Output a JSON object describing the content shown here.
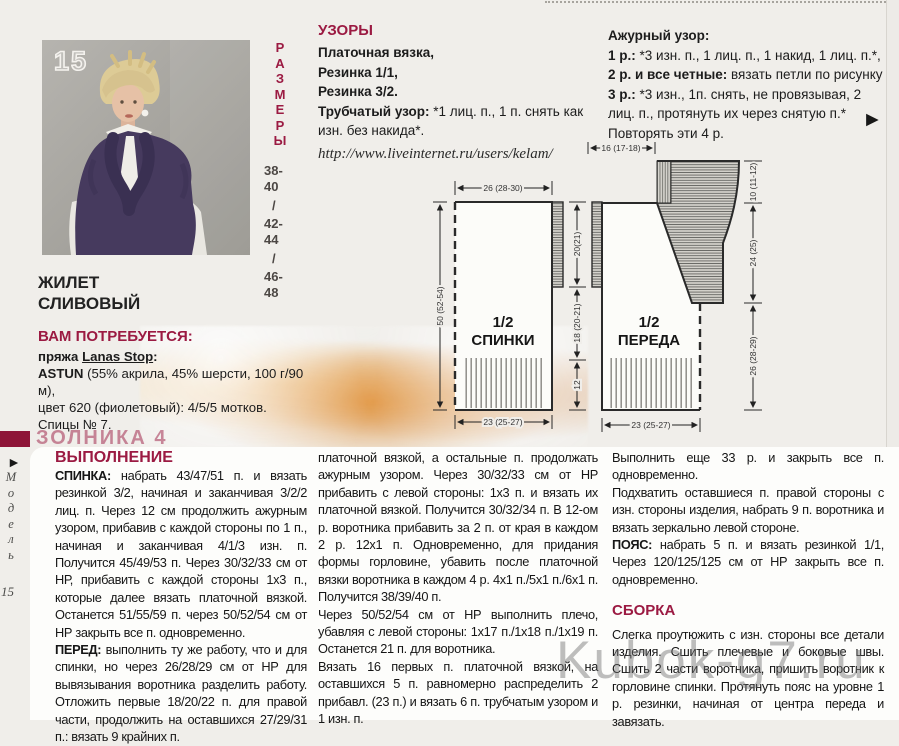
{
  "page": {
    "watermark": "Kubok-g7.ru"
  },
  "icons": {
    "pointer": "►"
  },
  "photo": {
    "number": "15"
  },
  "sizes": {
    "letters": [
      "Р",
      "А",
      "З",
      "М",
      "Е",
      "Р",
      "Ы"
    ],
    "values": [
      "38-",
      "40",
      "/",
      "42-",
      "44",
      "/",
      "46-",
      "48"
    ]
  },
  "left": {
    "title_line1": "ЖИЛЕТ",
    "title_line2": "СЛИВОВЫЙ",
    "requires_heading": "ВАМ ПОТРЕБУЕТСЯ:",
    "yarn_prefix": "пряжа ",
    "yarn_brand": "Lanas Stop",
    "yarn_brand_suffix": ":",
    "yarn_name": "ASTUN",
    "yarn_details": " (55% акрила, 45% шерсти, 100 г/90 м),",
    "yarn_color_line": "цвет 620 (фиолетовый): 4/5/5 мотков.",
    "needles": "Спицы № 7."
  },
  "patterns": {
    "heading": "УЗОРЫ",
    "line1": "Платочная вязка,",
    "line2": "Резинка 1/1,",
    "line3": "Резинка 3/2.",
    "tubular_label": "Трубчатый узор:",
    "tubular_text": " *1 лиц. п., 1 п. снять как изн. без накида*.",
    "url": "http://www.liveinternet.ru/users/kelam/"
  },
  "openwork": {
    "heading": "Ажурный узор:",
    "row1_label": "1 р.:",
    "row1_text": " *3 изн. п., 1 лиц. п., 1 накид, 1 лиц. п.*,",
    "row2_label": "2 р. и все четные:",
    "row2_text": " вязать петли по рисунку",
    "row3_label": "3 р.:",
    "row3_text": " *3 изн., 1п. снять, не провязывая, 2 лиц. п., протянуть их через снятую п.*",
    "repeat_line": "Повторять эти 4 р."
  },
  "diagram": {
    "back": {
      "half": "1/2",
      "name": "СПИНКИ",
      "width_top": "26 (28-30)",
      "width_bottom": "23 (25-27)",
      "height_left": "50 (52-54)",
      "seg_top": "20(21)",
      "seg_mid": "18 (20-21)",
      "seg_bottom": "12"
    },
    "front": {
      "half": "1/2",
      "name": "ПЕРЕДА",
      "width_top": "16 (17-18)",
      "width_bottom": "23 (25-27)",
      "seg_top": "10 (11-12)",
      "seg_mid": "24 (25)",
      "seg_bottom": "26 (28-29)"
    }
  },
  "instructions": {
    "heading": "ВЫПОЛНЕНИЕ",
    "col1": {
      "p1_label": "СПИНКА:",
      "p1_text": " набрать 43/47/51 п. и вязать резинкой 3/2, начиная и заканчивая 3/2/2 лиц. п. Через 12 см продолжить ажурным узором, прибавив с каждой стороны по 1 п., начиная и заканчивая 4/1/3 изн. п. Получится 45/49/53 п. Через 30/32/33 см от НР, прибавить с каждой стороны 1х3 п., которые далее вязать платочной вязкой. Останется 51/55/59 п. через 50/52/54 см от НР закрыть все п. одновременно.",
      "p2_label": "ПЕРЕД:",
      "p2_text": " выполнить ту же работу, что и для спинки, но через 26/28/29 см от НР для  вывязывания воротника разделить работу. Отложить первые  18/20/22 п. для правой части, продолжить на оставшихся 27/29/31 п.: вязать 9 крайних п."
    },
    "col2": {
      "p1": "платочной вязкой, а остальные п. продолжать ажурным узором. Через 30/32/33 см от НР прибавить с левой стороны: 1х3 п. и вязать их платочной вязкой. Получится 30/32/34 п. В 12-ом р. воротника прибавить за 2 п. от края в каждом 2 р. 12х1 п. Одновременно, для придания формы горловине, убавить после платочной вязки воротника в каждом 4 р. 4х1 п./5х1 п./6х1 п. Получится 38/39/40 п.",
      "p2": "Через 50/52/54 см от НР выполнить плечо, убавляя с левой стороны: 1х17 п./1х18 п./1х19 п. Останется 21 п. для воротника.",
      "p3": "Вязать 16 первых п. платочной вязкой, на оставшихся 5 п. равномерно распределить 2 прибавл. (23 п.) и вязать 6 п. трубчатым узором и 1 изн. п."
    },
    "col3": {
      "p1": "Выполнить еще 33 р. и закрыть все п. одновременно.",
      "p2": "Подхватить оставшиеся п.  правой стороны с изн. стороны изделия, набрать 9 п. воротника и вязать зеркально левой стороне.",
      "belt_label": "ПОЯС:",
      "belt_text": " набрать 5 п. и вязать резинкой 1/1, Через 120/125/125 см от НР закрыть все п. одновременно.",
      "assembly_heading": "СБОРКА",
      "assembly_text": "Слегка проутюжить с изн. стороны все детали изделия. Сшить плечевые и боковые швы. Сшить 2 части воротника, пришить воротник к горловине спинки. Протянуть пояс на уровне 1 р. резинки, начиная от центра переда и завязать."
    }
  },
  "margin": {
    "model_letters": [
      "М",
      "о",
      "д",
      "е",
      "л",
      "ь"
    ],
    "model_number": "15",
    "faded_heading": "ЗОЛНИКА 4"
  }
}
